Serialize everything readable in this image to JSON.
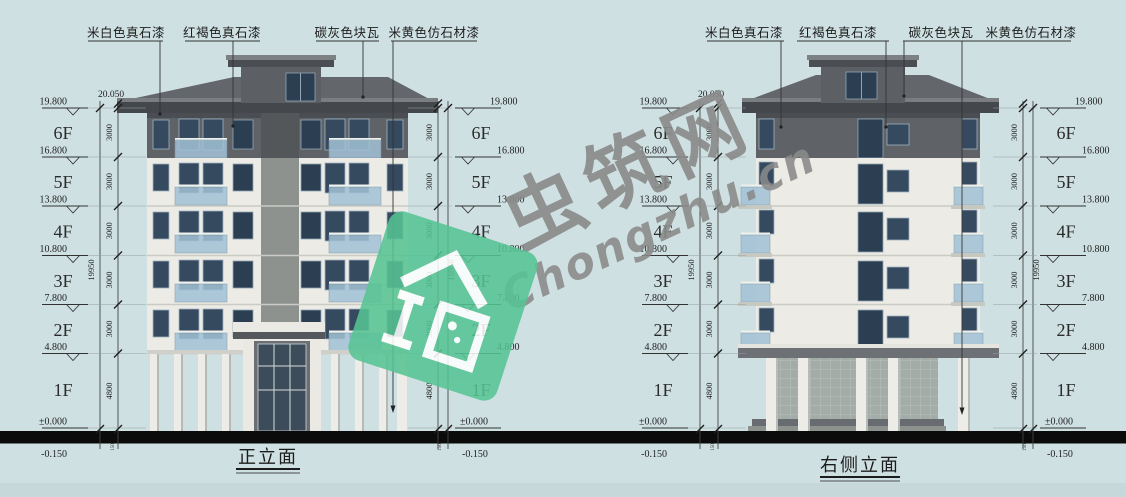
{
  "materials": [
    "米白色真石漆",
    "红褐色真石漆",
    "碳灰色块瓦",
    "米黄色仿石材漆"
  ],
  "floors": [
    "6F",
    "5F",
    "4F",
    "3F",
    "2F",
    "1F"
  ],
  "levels": [
    "19.800",
    "16.800",
    "13.800",
    "10.800",
    "7.800",
    "4.800"
  ],
  "level_zero": "±0.000",
  "level_base": "-0.150",
  "level_eave": "20.050",
  "dims": {
    "floor": "3000",
    "first": "4800",
    "total": "19950",
    "plinth": "150"
  },
  "titles": {
    "front": "正立面",
    "side": "右侧立面"
  },
  "watermark": {
    "zh": "虫筑网",
    "en": "Chongzhu.cn"
  },
  "colors": {
    "background": "#cfe0e2",
    "roof": "#63676b",
    "fascia": "#44484c",
    "attic_band": "#5f6367",
    "wall": "#ecebe5",
    "window": "#35495f",
    "balcony_glass": "#a2c2d6",
    "ground_band": "#0b0b0b",
    "watermark_gray": "#8a8a8a",
    "logo_green": "#56c493"
  }
}
